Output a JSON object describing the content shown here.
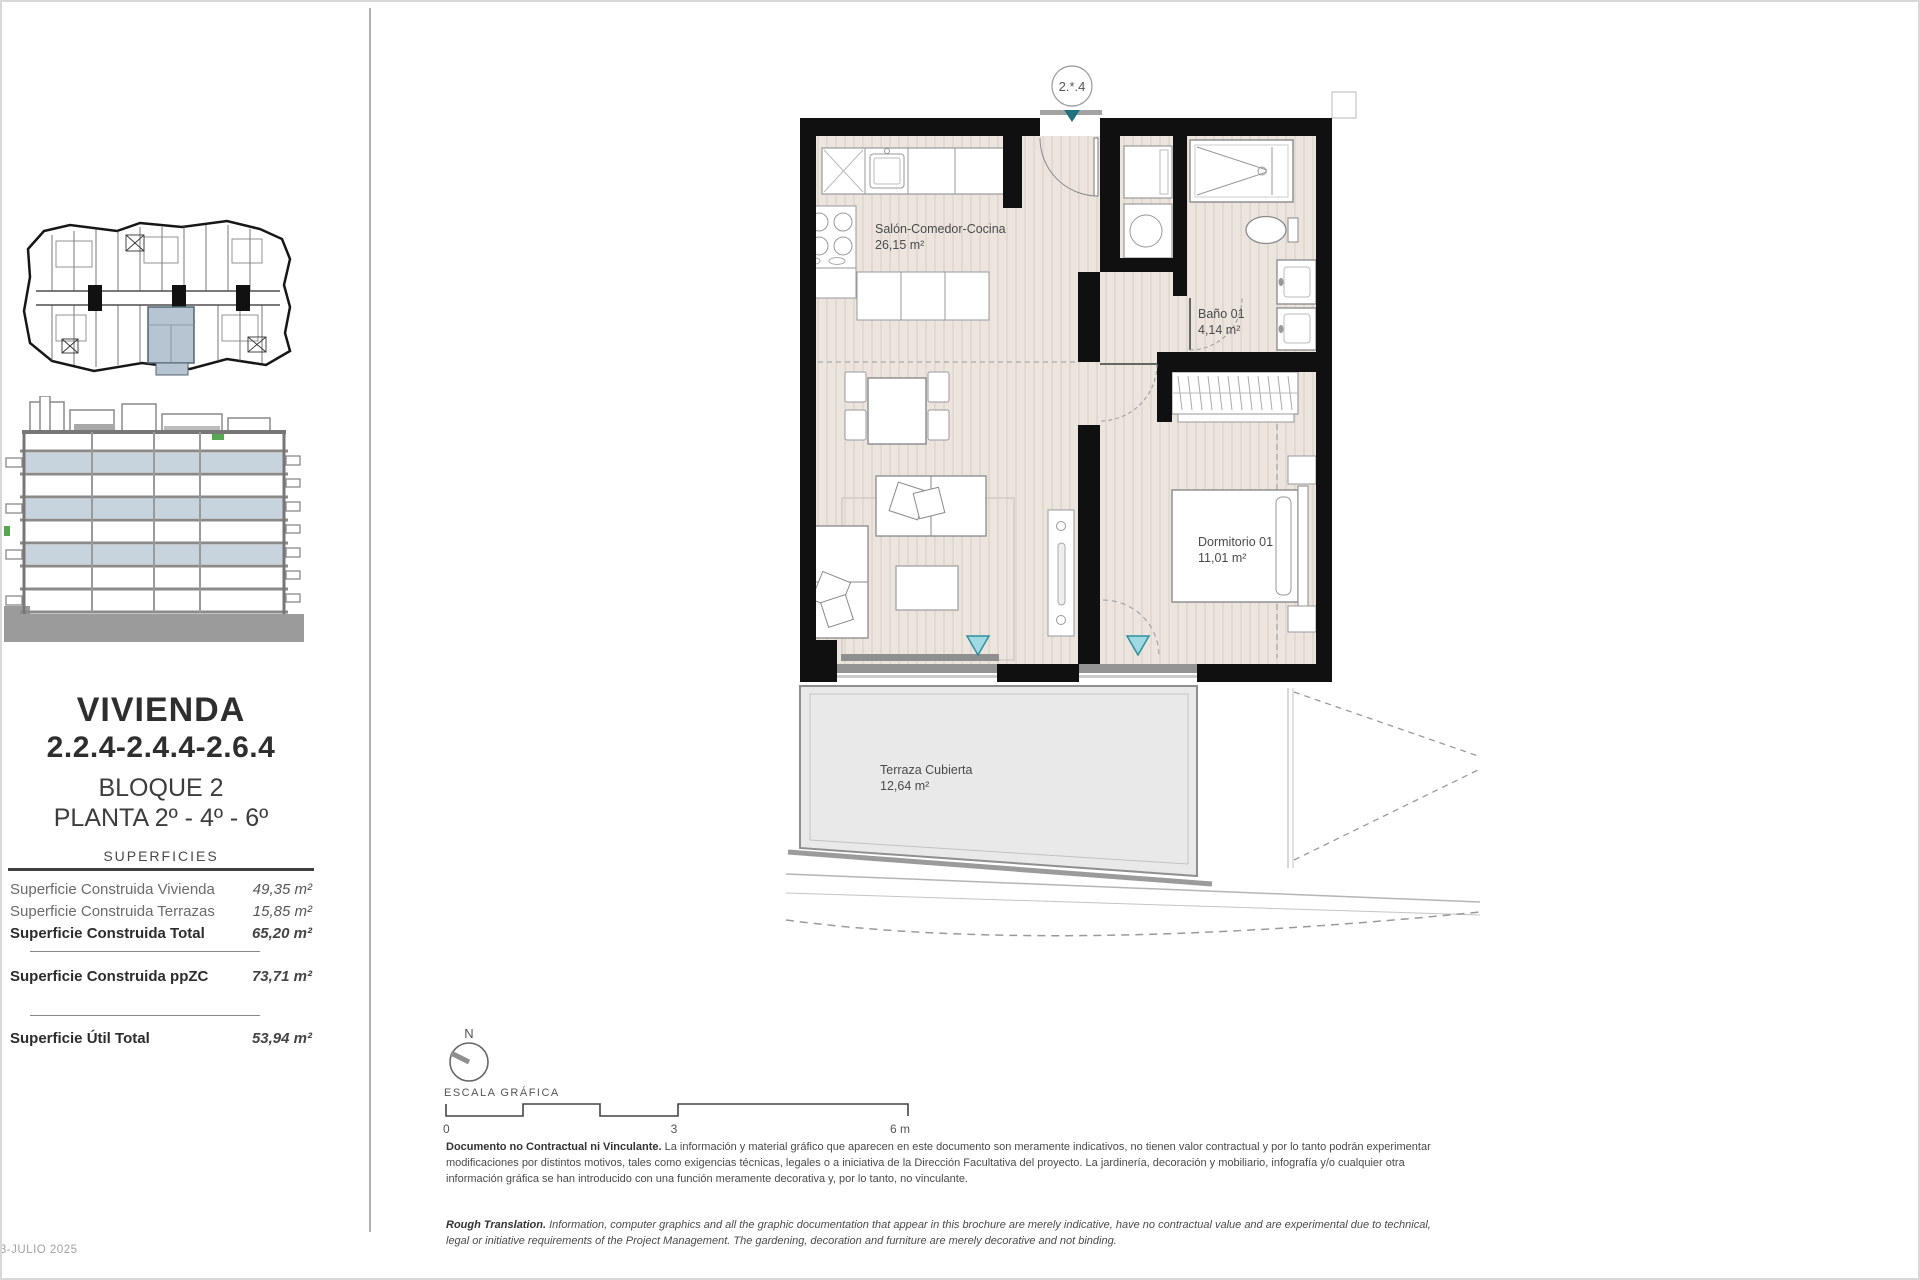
{
  "page": {
    "date": "03-JULIO 2025"
  },
  "sidebar": {
    "title": "VIVIENDA",
    "unit_numbers": "2.2.4-2.4.4-2.6.4",
    "block": "BLOQUE 2",
    "floors": "PLANTA 2º - 4º - 6º",
    "table_header": "SUPERFICIES",
    "rows": [
      {
        "label": "Superficie Construida Vivienda",
        "value": "49,35 m²"
      },
      {
        "label": "Superficie Construida Terrazas",
        "value": "15,85 m²"
      },
      {
        "label": "Superficie Construida Total",
        "value": "65,20 m²"
      },
      {
        "label": "Superficie Construida ppZC",
        "value": "73,71 m²"
      },
      {
        "label": "Superficie Útil Total",
        "value": "53,94 m²"
      }
    ]
  },
  "plan": {
    "badge": "2.*.4",
    "rooms": {
      "salon": {
        "name": "Salón-Comedor-Cocina",
        "area": "26,15 m²"
      },
      "bano": {
        "name": "Baño 01",
        "area": "4,14 m²"
      },
      "dormitorio": {
        "name": "Dormitorio 01",
        "area": "11,01 m²"
      },
      "terraza": {
        "name": "Terraza Cubierta",
        "area": "12,64 m²"
      }
    }
  },
  "legend": {
    "north": "N",
    "scale_label": "ESCALA GRÁFICA",
    "tick0": "0",
    "tick3": "3",
    "tick6": "6 m"
  },
  "disclaimer": {
    "es_lead": "Documento no Contractual ni Vinculante.",
    "es_body": " La información y material gráfico que aparecen en este documento son meramente indicativos, no tienen valor contractual y por lo tanto podrán experimentar modificaciones por distintos motivos, tales como exigencias técnicas, legales o a iniciativa de la Dirección Facultativa del proyecto. La jardinería, decoración y mobiliario, infografía y/o cualquier otra información gráfica se han introducido con una función meramente decorativa y, por lo tanto, no vinculante.",
    "en_lead": "Rough Translation.",
    "en_body": " Information, computer graphics and all the graphic documentation that appear in this brochure are merely indicative, have no contractual value and are experimental due to technical, legal or initiative requirements of the Project Management. The gardening, decoration and furniture are merely decorative and not binding."
  },
  "colors": {
    "wall_black": "#101010",
    "floor_beige": "#ece5de",
    "terrace_gray": "#e9e9e9",
    "accent_teal": "#9fd9e3",
    "badge_teal": "#20717f",
    "highlight_blue": "#b6c5d1",
    "elevation_blue": "#c8d4dd",
    "green_accent": "#55a84c"
  }
}
